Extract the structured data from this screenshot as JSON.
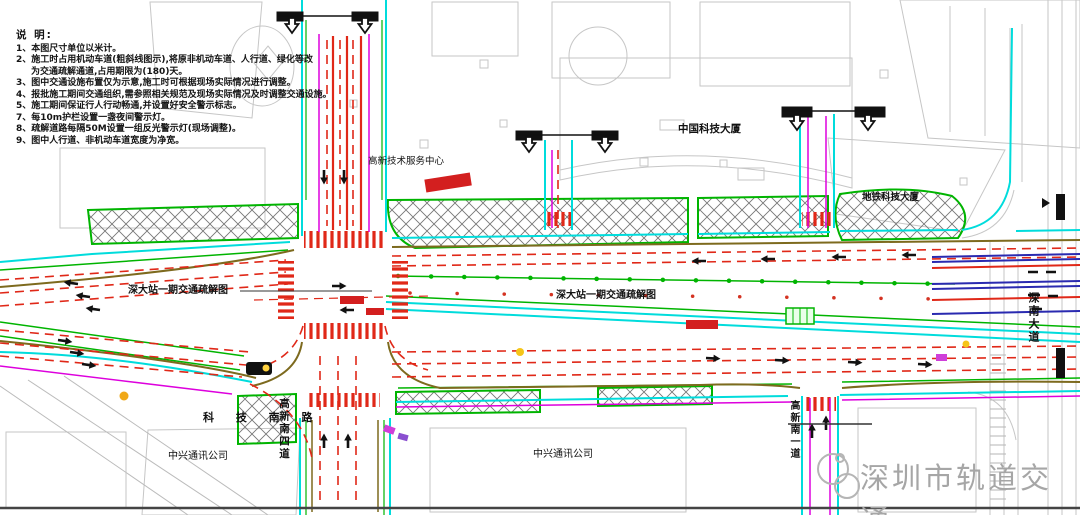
{
  "title": "深大站一期交通疏解图",
  "notes": {
    "heading": "说 明:",
    "lines": [
      "1、本图尺寸单位以米计。",
      "2、施工时占用机动车道(粗斜线图示),将原非机动车道、人行道、绿化等改",
      "为交通疏解通道,占用期限为(180)天。",
      "3、图中交通设施布置仅为示意,施工时可根据现场实际情况进行调整。",
      "4、报批施工期间交通组织,需参照相关规范及现场实际情况及时调整交通设施。",
      "5、施工期间保证行人行动畅通,并设置好安全警示标志。",
      "7、每10m护栏设置一盏夜间警示灯。",
      "8、疏解道路每隔50M设置一组反光警示灯(现场调整)。",
      "9、图中人行道、非机动车道宽度为净宽。"
    ]
  },
  "labels": {
    "plan_label_left": "深大站一期交通疏解图",
    "plan_label_center": "深大站一期交通疏解图",
    "building_hi_tech_center": "高新技术服务中心",
    "building_china_tech": "中国科技大厦",
    "building_metro_tech": "地铁科技大厦",
    "building_zte_left": "中兴通讯公司",
    "building_zte_center": "中兴通讯公司",
    "road_keji_south": "科 技 南 路",
    "road_gaoxin_s4": "高新南四道",
    "road_gaoxin_s1": "高新南一道",
    "road_shennan": "深南大道"
  },
  "watermark": {
    "text": "深圳市轨道交通",
    "logo": "rail-transit-logo"
  },
  "colors": {
    "road_outline_cyan": "#00dcdc",
    "greenery_green": "#00b400",
    "diversion_red": "#e02818",
    "barrier_red": "#d31f1f",
    "utility_magenta": "#dd00dd",
    "curb_olive": "#7d6a1e",
    "metro_navy": "#2a2ab0",
    "building_gray": "#c6c6c6",
    "watermark_gray": "#a6a6a6"
  }
}
